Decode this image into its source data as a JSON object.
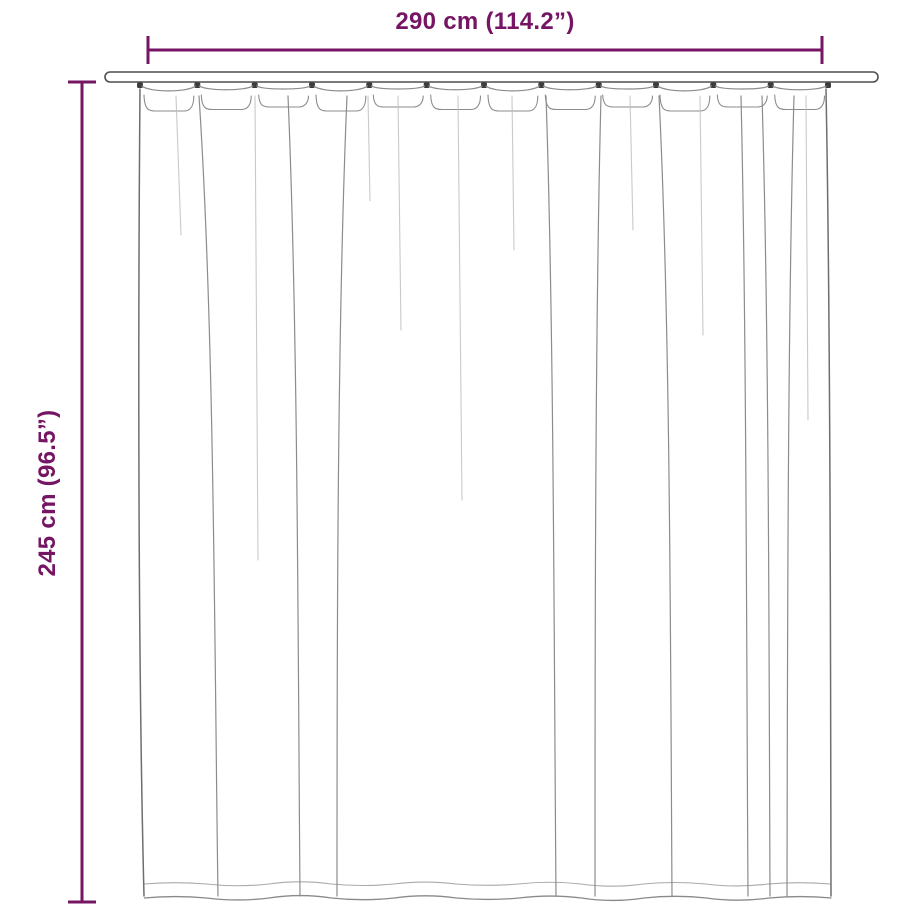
{
  "colors": {
    "accent": "#751563",
    "line": "#8c8c8c",
    "line-dark": "#4f4f4f",
    "fade": "#bfbfbf",
    "bg": "#ffffff"
  },
  "dimensions": {
    "width_label": "290 cm (114.2”)",
    "height_label": "245 cm (96.5”)"
  },
  "diagram": {
    "subject": "pleated curtain hanging on rod"
  }
}
